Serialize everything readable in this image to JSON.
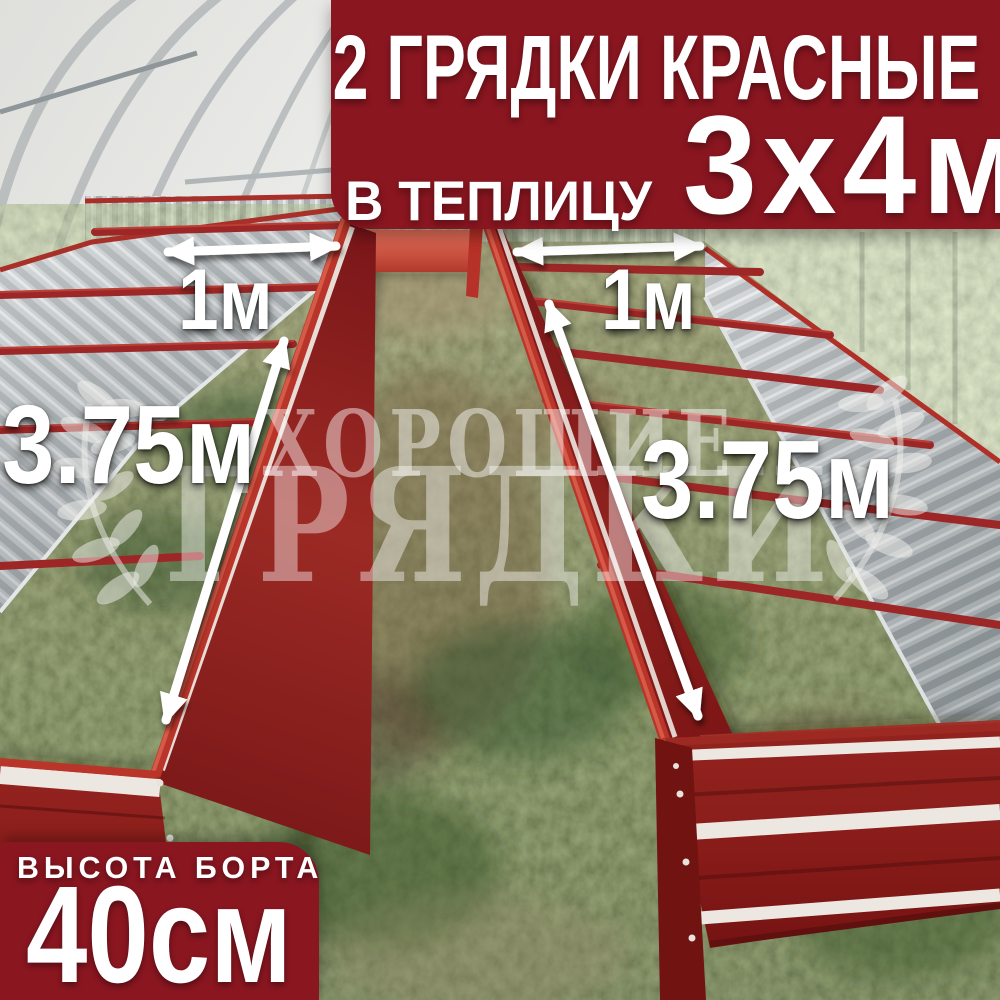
{
  "meta": {
    "description": "Product photo: two red metal raised garden beds installed inside a polycarbonate greenhouse, with white dimension arrows and marketing text overlays",
    "image_width": 1000,
    "image_height": 1000
  },
  "colors": {
    "banner_red": "#8a1620",
    "bed_red_dark": "#7a1619",
    "bed_red": "#9c2a24",
    "rail_red": "#b93429",
    "stripe_white": "#ece7e0",
    "galvanized_silver": "#c9cdcf",
    "text_white": "#ffffff",
    "watermark_white": "rgba(255,255,255,0.45)"
  },
  "banner": {
    "line1": "2 ГРЯДКИ КРАСНЫЕ",
    "line2_prefix": "В ТЕПЛИЦУ",
    "line2_size": "3х4м"
  },
  "badge": {
    "title": "ВЫСОТА БОРТА",
    "value": "40см"
  },
  "dimensions": {
    "left_width": "1м",
    "right_width": "1м",
    "left_length": "3.75м",
    "right_length": "3.75м"
  },
  "watermark": {
    "line1": "ХОРОШИЕ",
    "line2": "ГРЯДКИ"
  }
}
